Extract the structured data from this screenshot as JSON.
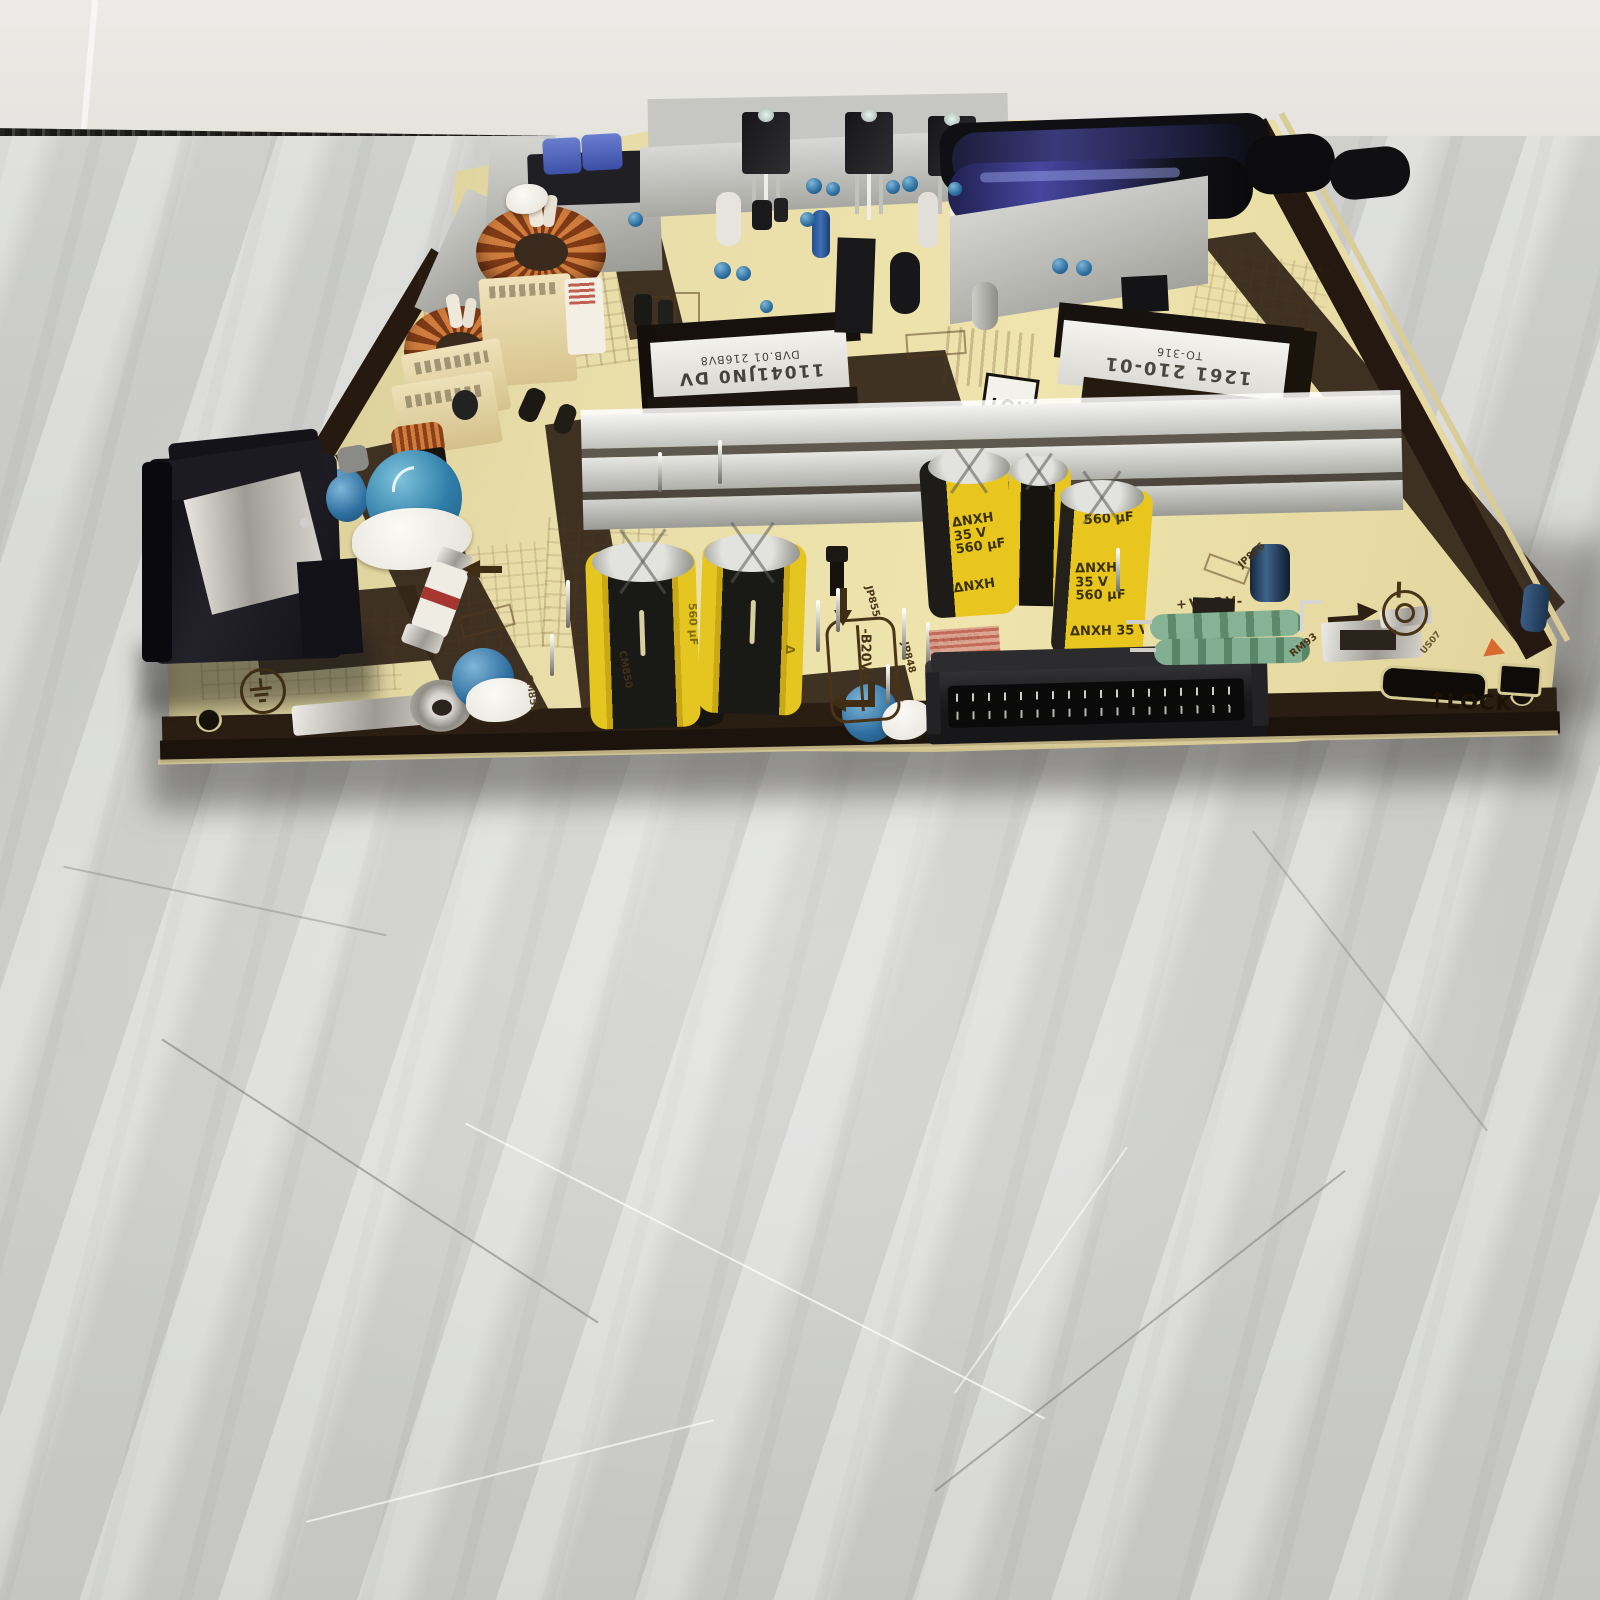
{
  "photo": {
    "subject": "TV power supply circuit board lying on a gray concrete floor against a white wall",
    "background": {
      "wall_color": "#eae8e3",
      "floor_color": "#d2d3d0"
    }
  },
  "board": {
    "pcb_color": "#e6dca6",
    "solder_mask_dark": "#342619",
    "silkscreen": {
      "hot": "HOT",
      "lock": "LOCK",
      "lock_arrow": "↑",
      "vdrv": "+VDRV-",
      "b20v": "-B20V+",
      "jp855": "JP855",
      "jp845": "JP845",
      "jp848": "JP848",
      "jp852": "JP852",
      "jp806": "JP806",
      "rm93": "RM93",
      "cm969": "CM969",
      "cm850": "CM850",
      "cm851": "CM851",
      "us07": "US07"
    },
    "transformer_left": {
      "label_line1": "11041JN0 DV",
      "label_line2": "DVB.01 216BV8"
    },
    "transformer_right": {
      "label_line1": "1261 210-01",
      "label_line2": "TO-316"
    },
    "yellow_capacitor": {
      "logo": "Δ",
      "brand": "NXH",
      "voltage": "35 V",
      "capacity": "560 µF"
    }
  }
}
